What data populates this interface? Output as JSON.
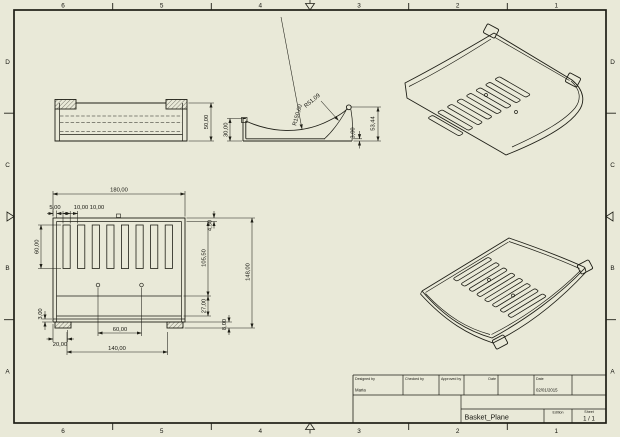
{
  "sheet": {
    "background_color": "#e9e9d8",
    "line_color": "#1e1e16",
    "zones": {
      "top": [
        "6",
        "5",
        "4",
        "3",
        "2",
        "1"
      ],
      "bottom": [
        "6",
        "5",
        "4",
        "3",
        "2",
        "1"
      ],
      "left": [
        "D",
        "C",
        "B",
        "A"
      ],
      "right": [
        "D",
        "C",
        "B",
        "A"
      ]
    }
  },
  "title_block": {
    "designed_by_label": "Designed by",
    "designed_by_value": "Maria",
    "checked_by_label": "Checked by",
    "approved_by_label": "Approved by",
    "date_label": "Date",
    "date2_label": "Date",
    "date_value": "02/01/2015",
    "part_name": "Basket_Plane",
    "edition_label": "Edition",
    "sheet_label": "Sheet",
    "sheet_value": "1 / 1"
  },
  "dimensions": {
    "front_view": {
      "height": "50,00"
    },
    "side_view": {
      "left_height": "30,00",
      "outer_radius": "R150,00",
      "inner_radius": "R51,09",
      "right_height": "53,44",
      "base_thickness": "3,00"
    },
    "plan_view": {
      "overall_width": "180,00",
      "edge_to_slot": "5,00",
      "slot_width": "10,00",
      "slot_gap": "10,00",
      "slot_length": "60,00",
      "top_margin": "4,50",
      "slot_zone_depth": "105,50",
      "overall_depth": "148,00",
      "lower_zone": "27,00",
      "tab_height": "8,00",
      "wall_thickness": "3,00",
      "tab_offset": "20,00",
      "hole_spacing": "60,00",
      "tab_span": "140,00"
    }
  }
}
